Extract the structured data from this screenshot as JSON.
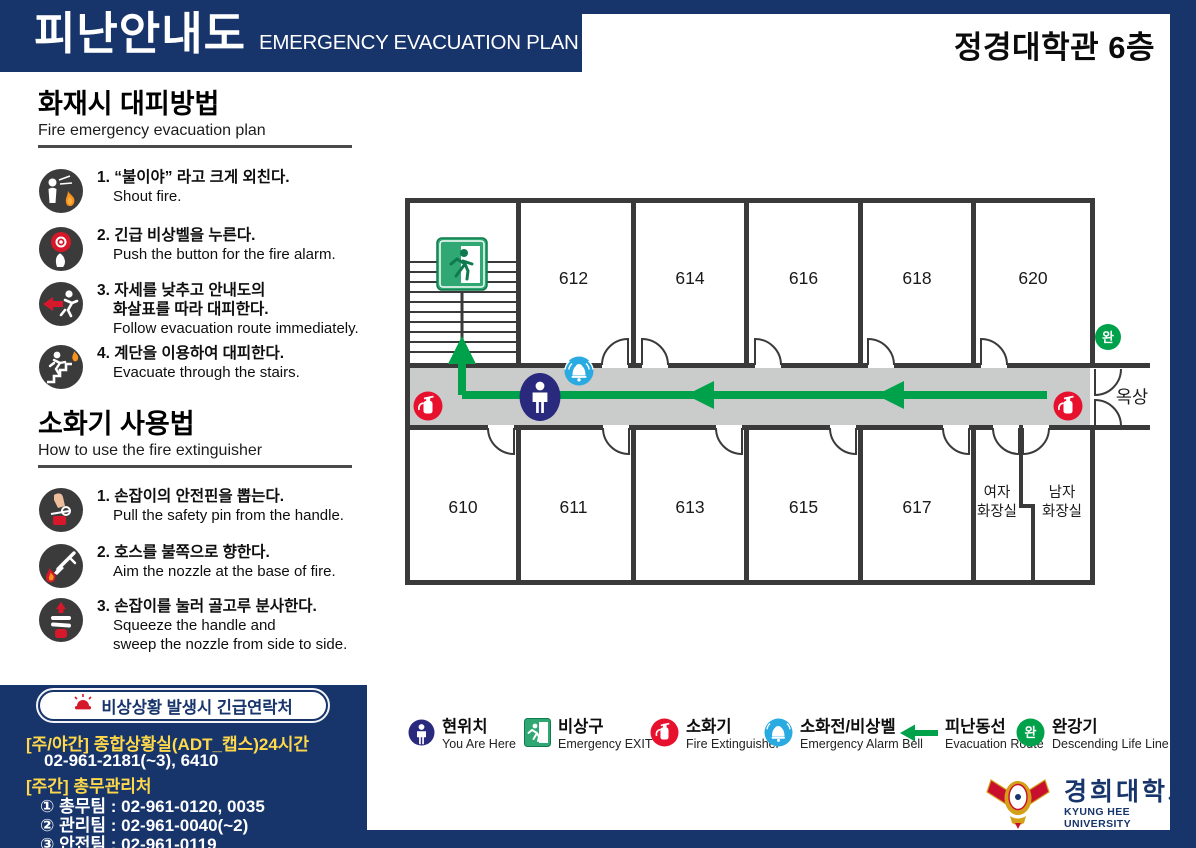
{
  "header": {
    "title_ko": "피난안내도",
    "title_en": "EMERGENCY EVACUATION PLAN",
    "location": "정경대학관 6층"
  },
  "evac": {
    "title": "화재시 대피방법",
    "subtitle": "Fire emergency evacuation plan",
    "items": [
      {
        "ko1": "1. “불이야” 라고 크게 외친다.",
        "en1": "Shout fire."
      },
      {
        "ko1": "2. 긴급 비상벨을 누른다.",
        "en1": "Push the button for the fire alarm."
      },
      {
        "ko1": "3. 자세를 낮추고 안내도의",
        "ko2": "화살표를 따라 대피한다.",
        "en1": "Follow evacuation route immediately."
      },
      {
        "ko1": "4. 계단을 이용하여 대피한다.",
        "en1": "Evacuate through the stairs."
      }
    ]
  },
  "ext": {
    "title": "소화기 사용법",
    "subtitle": "How to use the fire extinguisher",
    "items": [
      {
        "ko1": "1. 손잡이의 안전핀을 뽑는다.",
        "en1": "Pull the safety pin from the handle."
      },
      {
        "ko1": "2. 호스를 불쪽으로 향한다.",
        "en1": "Aim the nozzle at the base of fire."
      },
      {
        "ko1": "3. 손잡이를 눌러 골고루 분사한다.",
        "en1": "Squeeze the handle and",
        "en2": "sweep the nozzle from side to side."
      }
    ]
  },
  "contact": {
    "badge": "비상상황 발생시 긴급연락처",
    "line1": "[주/야간] 종합상황실(ADT_캡스)24시간",
    "line2": "02-961-2181(~3), 6410",
    "line3": "[주간] 총무관리처",
    "line4": "① 총무팀 : 02-961-0120, 0035",
    "line5": "② 관리팀 : 02-961-0040(~2)",
    "line6": "③ 안전팀 : 02-961-0119"
  },
  "floorplan": {
    "rooms_top": [
      "612",
      "614",
      "616",
      "618",
      "620"
    ],
    "rooms_bottom": [
      "610",
      "611",
      "613",
      "615",
      "617"
    ],
    "toilet_w1": "여자",
    "toilet_w2": "화장실",
    "toilet_m1": "남자",
    "toilet_m2": "화장실",
    "rooftop": "옥상",
    "wan": "완"
  },
  "legend": {
    "items": [
      {
        "ko": "현위치",
        "en": "You Are Here"
      },
      {
        "ko": "비상구",
        "en": "Emergency EXIT"
      },
      {
        "ko": "소화기",
        "en": "Fire Extinguisher"
      },
      {
        "ko": "소화전/비상벨",
        "en": "Emergency Alarm Bell"
      },
      {
        "ko": "피난동선",
        "en": "Evacuation Route"
      },
      {
        "ko": "완강기",
        "en": "Descending Life Line"
      }
    ]
  },
  "logo": {
    "ko": "경희대학교",
    "en": "KYUNG HEE UNIVERSITY"
  },
  "colors": {
    "navy": "#17346B",
    "green": "#00A14B",
    "exit_green": "#2FA873",
    "exit_green_dark": "#0E7A4E",
    "red": "#E8112D",
    "blue": "#29ABE2",
    "person_navy": "#29297E",
    "yellow": "#FFD94A",
    "corridor": "#CACBCB",
    "wall": "#3A3A3A",
    "flame_orange": "#F7931E",
    "icon_dark": "#3B3B3B"
  }
}
